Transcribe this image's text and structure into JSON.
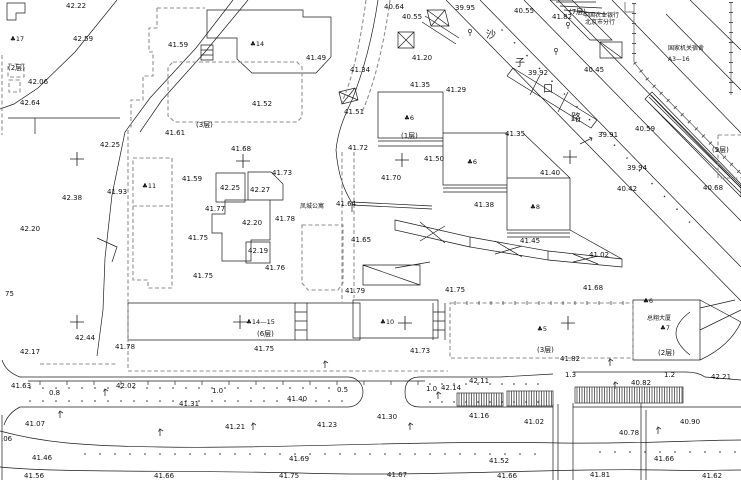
{
  "drawing": {
    "type": "cadastral-site-plan",
    "background": "#ffffff",
    "ink_color": "#1c1c1c",
    "parcel_line_color": "#8f8f8f",
    "road_name": "沙子口路"
  },
  "annotations": {
    "road_name_chars": [
      {
        "t": "沙",
        "x": 486,
        "y": 38
      },
      {
        "t": "子",
        "x": 515,
        "y": 66
      },
      {
        "t": "口",
        "x": 543,
        "y": 92
      },
      {
        "t": "路",
        "x": 571,
        "y": 121
      }
    ],
    "place_names": [
      {
        "t": "凤城公寓",
        "x": 300,
        "y": 208
      },
      {
        "t": "中国农业银行",
        "x": 583,
        "y": 17,
        "s": 5
      },
      {
        "t": "北京市分行",
        "x": 585,
        "y": 24,
        "s": 5
      },
      {
        "t": "国家机关宿舍",
        "x": 668,
        "y": 50
      },
      {
        "t": "A3—16",
        "x": 668,
        "y": 61
      },
      {
        "t": "总翔大厦",
        "x": 647,
        "y": 320
      }
    ],
    "building_numbers": [
      {
        "t": "♣17",
        "x": 10,
        "y": 41
      },
      {
        "t": "♣14",
        "x": 250,
        "y": 46
      },
      {
        "t": "♣11",
        "x": 142,
        "y": 188
      },
      {
        "t": "♣6",
        "x": 404,
        "y": 120
      },
      {
        "t": "♣6",
        "x": 467,
        "y": 164
      },
      {
        "t": "♣8",
        "x": 530,
        "y": 209
      },
      {
        "t": "♣14—15",
        "x": 246,
        "y": 324
      },
      {
        "t": "♣10",
        "x": 380,
        "y": 324
      },
      {
        "t": "♣5",
        "x": 537,
        "y": 331
      },
      {
        "t": "♣7",
        "x": 660,
        "y": 330
      },
      {
        "t": "♣6",
        "x": 643,
        "y": 303
      }
    ],
    "floors": [
      {
        "t": "(2层)",
        "x": 8,
        "y": 70
      },
      {
        "t": "(7层)",
        "x": 569,
        "y": 14
      },
      {
        "t": "(3层)",
        "x": 196,
        "y": 127
      },
      {
        "t": "(1层)",
        "x": 401,
        "y": 138
      },
      {
        "t": "(5层)",
        "x": 712,
        "y": 152
      },
      {
        "t": "(6层)",
        "x": 257,
        "y": 336
      },
      {
        "t": "(3层)",
        "x": 537,
        "y": 352
      },
      {
        "t": "(2层)",
        "x": 658,
        "y": 355
      }
    ],
    "widths": [
      {
        "t": "0.8",
        "x": 49,
        "y": 395
      },
      {
        "t": "1.0",
        "x": 212,
        "y": 393
      },
      {
        "t": "0.5",
        "x": 337,
        "y": 392
      },
      {
        "t": "1.0",
        "x": 426,
        "y": 391
      },
      {
        "t": "1.3",
        "x": 565,
        "y": 377
      },
      {
        "t": "1.2",
        "x": 664,
        "y": 377
      }
    ],
    "elevations": [
      {
        "t": "42.22",
        "x": 66,
        "y": 8
      },
      {
        "t": "42.59",
        "x": 73,
        "y": 41
      },
      {
        "t": "42.06",
        "x": 28,
        "y": 84
      },
      {
        "t": "42.64",
        "x": 20,
        "y": 105
      },
      {
        "t": "41.59",
        "x": 168,
        "y": 47
      },
      {
        "t": "41.49",
        "x": 306,
        "y": 60
      },
      {
        "t": "40.64",
        "x": 384,
        "y": 9
      },
      {
        "t": "40.55",
        "x": 402,
        "y": 19
      },
      {
        "t": "39.95",
        "x": 455,
        "y": 10
      },
      {
        "t": "40.55",
        "x": 514,
        "y": 13
      },
      {
        "t": "41.82",
        "x": 552,
        "y": 19
      },
      {
        "t": "40.45",
        "x": 584,
        "y": 72
      },
      {
        "t": "39.92",
        "x": 528,
        "y": 75
      },
      {
        "t": "41.20",
        "x": 412,
        "y": 60
      },
      {
        "t": "41.34",
        "x": 350,
        "y": 72
      },
      {
        "t": "41.35",
        "x": 410,
        "y": 87
      },
      {
        "t": "41.29",
        "x": 446,
        "y": 92
      },
      {
        "t": "41.52",
        "x": 252,
        "y": 106
      },
      {
        "t": "41.51",
        "x": 344,
        "y": 114
      },
      {
        "t": "41.61",
        "x": 165,
        "y": 135
      },
      {
        "t": "42.25",
        "x": 100,
        "y": 147
      },
      {
        "t": "41.68",
        "x": 231,
        "y": 151
      },
      {
        "t": "41.93",
        "x": 107,
        "y": 194
      },
      {
        "t": "42.38",
        "x": 62,
        "y": 200
      },
      {
        "t": "42.20",
        "x": 20,
        "y": 231
      },
      {
        "t": "41.73",
        "x": 272,
        "y": 175
      },
      {
        "t": "41.59",
        "x": 182,
        "y": 181
      },
      {
        "t": "42.25",
        "x": 220,
        "y": 190
      },
      {
        "t": "42.27",
        "x": 250,
        "y": 192
      },
      {
        "t": "41.77",
        "x": 205,
        "y": 211
      },
      {
        "t": "42.20",
        "x": 242,
        "y": 225
      },
      {
        "t": "41.78",
        "x": 275,
        "y": 221
      },
      {
        "t": "41.64",
        "x": 336,
        "y": 206
      },
      {
        "t": "41.75",
        "x": 188,
        "y": 240
      },
      {
        "t": "42.19",
        "x": 248,
        "y": 253
      },
      {
        "t": "41.65",
        "x": 351,
        "y": 242
      },
      {
        "t": "41.76",
        "x": 265,
        "y": 270
      },
      {
        "t": "41.75",
        "x": 193,
        "y": 278
      },
      {
        "t": "41.72",
        "x": 348,
        "y": 150
      },
      {
        "t": "41.50",
        "x": 424,
        "y": 161
      },
      {
        "t": "41.70",
        "x": 381,
        "y": 180
      },
      {
        "t": "41.35",
        "x": 505,
        "y": 136
      },
      {
        "t": "41.40",
        "x": 540,
        "y": 175
      },
      {
        "t": "41.38",
        "x": 474,
        "y": 207
      },
      {
        "t": "41.45",
        "x": 520,
        "y": 243
      },
      {
        "t": "40.59",
        "x": 635,
        "y": 131
      },
      {
        "t": "39.91",
        "x": 598,
        "y": 137
      },
      {
        "t": "39.94",
        "x": 627,
        "y": 170
      },
      {
        "t": "40.42",
        "x": 617,
        "y": 191
      },
      {
        "t": "40.68",
        "x": 703,
        "y": 190
      },
      {
        "t": "41.02",
        "x": 589,
        "y": 257
      },
      {
        "t": "41.68",
        "x": 583,
        "y": 290
      },
      {
        "t": "41.79",
        "x": 345,
        "y": 293
      },
      {
        "t": "41.75",
        "x": 445,
        "y": 292
      },
      {
        "t": "41.75",
        "x": 254,
        "y": 351
      },
      {
        "t": "41.73",
        "x": 410,
        "y": 353
      },
      {
        "t": "41.78",
        "x": 115,
        "y": 349
      },
      {
        "t": "42.44",
        "x": 75,
        "y": 340
      },
      {
        "t": "42.17",
        "x": 20,
        "y": 354
      },
      {
        "t": "41.82",
        "x": 560,
        "y": 361
      },
      {
        "t": "42.21",
        "x": 711,
        "y": 379
      },
      {
        "t": "40.82",
        "x": 631,
        "y": 385
      },
      {
        "t": "42.11",
        "x": 469,
        "y": 383
      },
      {
        "t": "42.14",
        "x": 441,
        "y": 390
      },
      {
        "t": "41.40",
        "x": 287,
        "y": 401
      },
      {
        "t": "41.31",
        "x": 179,
        "y": 406
      },
      {
        "t": "42.02",
        "x": 116,
        "y": 388
      },
      {
        "t": "41.63",
        "x": 11,
        "y": 388
      },
      {
        "t": "41.07",
        "x": 25,
        "y": 426
      },
      {
        "t": "41.21",
        "x": 225,
        "y": 429
      },
      {
        "t": "41.23",
        "x": 317,
        "y": 427
      },
      {
        "t": "41.30",
        "x": 377,
        "y": 419
      },
      {
        "t": "41.16",
        "x": 469,
        "y": 418
      },
      {
        "t": "41.02",
        "x": 524,
        "y": 424
      },
      {
        "t": "40.78",
        "x": 619,
        "y": 435
      },
      {
        "t": "40.90",
        "x": 680,
        "y": 424
      },
      {
        "t": ".06",
        "x": 1,
        "y": 441
      },
      {
        "t": "41.46",
        "x": 32,
        "y": 460
      },
      {
        "t": "41.69",
        "x": 289,
        "y": 461
      },
      {
        "t": "41.66",
        "x": 654,
        "y": 461
      },
      {
        "t": "41.52",
        "x": 489,
        "y": 463
      },
      {
        "t": "41.56",
        "x": 24,
        "y": 478
      },
      {
        "t": "41.66",
        "x": 154,
        "y": 478
      },
      {
        "t": "41.75",
        "x": 279,
        "y": 478
      },
      {
        "t": "41.67",
        "x": 387,
        "y": 477
      },
      {
        "t": "41.66",
        "x": 497,
        "y": 478
      },
      {
        "t": "41.81",
        "x": 590,
        "y": 477
      },
      {
        "t": "41.62",
        "x": 702,
        "y": 478
      },
      {
        "t": "75",
        "x": 5,
        "y": 296
      }
    ]
  },
  "survey_crosses": [
    [
      77,
      159
    ],
    [
      243,
      161
    ],
    [
      402,
      160
    ],
    [
      570,
      157
    ],
    [
      77,
      322
    ],
    [
      240,
      322
    ],
    [
      405,
      323
    ],
    [
      568,
      323
    ]
  ]
}
